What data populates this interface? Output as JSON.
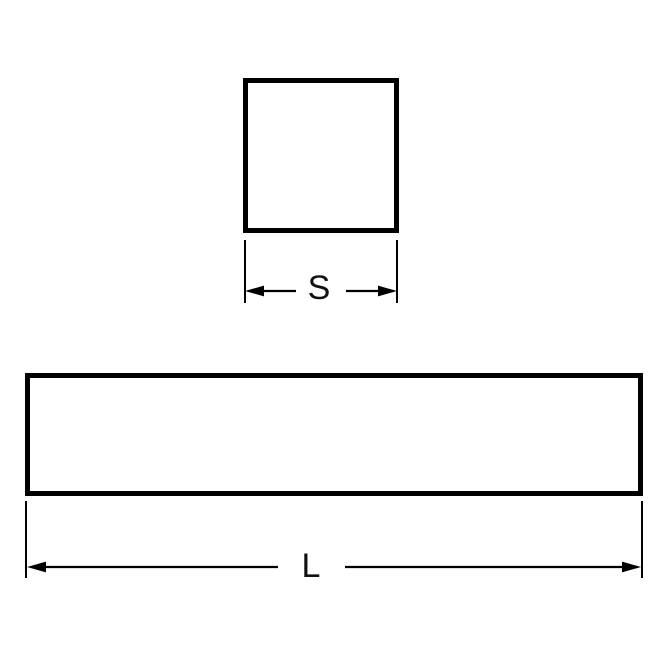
{
  "canvas": {
    "background": "#ffffff",
    "line_color": "#000000"
  },
  "cross_section_view": {
    "shape": "square",
    "dimension_label": "S"
  },
  "length_view": {
    "shape": "rectangle",
    "dimension_label": "L"
  }
}
